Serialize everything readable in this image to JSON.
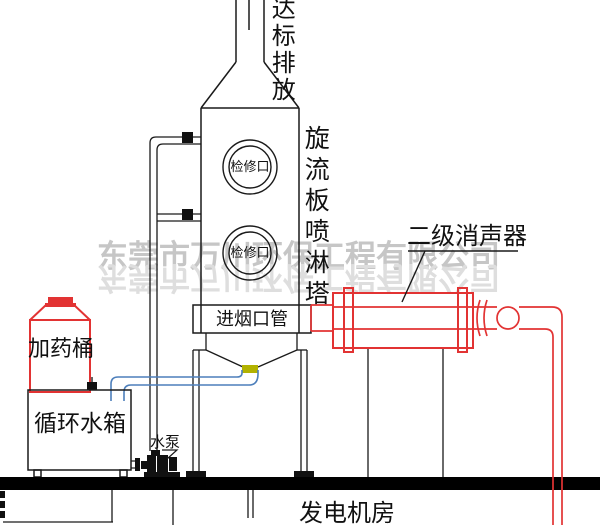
{
  "labels": {
    "stack_outlet": "达标排放",
    "tower_name": "旋流板喷淋塔",
    "inspection_port_top": "检修口",
    "inspection_port_bottom": "检修口",
    "smoke_inlet_duct": "进烟口管",
    "silencer": "二级消声器",
    "dosing_tank": "加药桶",
    "circulating_water_tank": "循环水箱",
    "water_pump": "水泵",
    "generator_room": "发电机房"
  },
  "watermark": {
    "line1": "东莞市万川环保工程有限公司",
    "line2": "东莞市万川环保工程有限公司"
  },
  "colors": {
    "line_black": "#1a1a1a",
    "equipment_red": "#e23333",
    "pipe_blue": "#4d7fbb",
    "drain_olive": "#b2b200",
    "watermark_gray": "#c6c6c6",
    "watermark_reflection_gray": "#dedede"
  }
}
